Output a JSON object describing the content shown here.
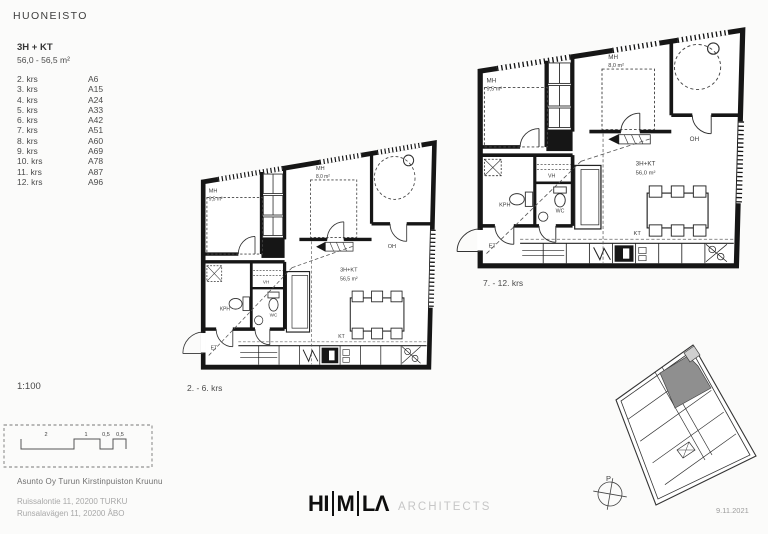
{
  "sheet": {
    "title": "HUONEISTO"
  },
  "apartment": {
    "type": "3H + KT",
    "area_range": "56,0 - 56,5 m²"
  },
  "floor_units": [
    {
      "floor": "2. krs",
      "unit": "A6"
    },
    {
      "floor": "3. krs",
      "unit": "A15"
    },
    {
      "floor": "4. krs",
      "unit": "A24"
    },
    {
      "floor": "5. krs",
      "unit": "A33"
    },
    {
      "floor": "6. krs",
      "unit": "A42"
    },
    {
      "floor": "7. krs",
      "unit": "A51"
    },
    {
      "floor": "8. krs",
      "unit": "A60"
    },
    {
      "floor": "9. krs",
      "unit": "A69"
    },
    {
      "floor": "10. krs",
      "unit": "A78"
    },
    {
      "floor": "11. krs",
      "unit": "A87"
    },
    {
      "floor": "12. krs",
      "unit": "A96"
    }
  ],
  "scale": {
    "ratio": "1:100",
    "bar_labels": [
      "2",
      "1",
      "0,5",
      "0,5"
    ]
  },
  "project": {
    "name": "Asunto Oy Turun Kirstinpuiston Kruunu",
    "address_fi": "Ruissalontie 11, 20200 TURKU",
    "address_sv": "Runsalavägen 11, 20200 ÅBO"
  },
  "plans": [
    {
      "caption": "2. - 6. krs",
      "unit_type": "3H+KT",
      "unit_area": "56,5 m²",
      "rooms": {
        "mh1": "MH",
        "mh1_area": "9,5 m²",
        "mh2": "MH",
        "mh2_area": "8,0 m²",
        "oh": "OH",
        "kph": "KPH",
        "wc": "WC",
        "vh": "VH",
        "et": "ET",
        "kt": "KT"
      }
    },
    {
      "caption": "7. - 12. krs",
      "unit_type": "3H+KT",
      "unit_area": "56,0 m²",
      "rooms": {
        "mh1": "MH",
        "mh1_area": "9,5 m²",
        "mh2": "MH",
        "mh2_area": "8,0 m²",
        "oh": "OH",
        "kph": "KPH",
        "wc": "WC",
        "vh": "VH",
        "et": "ET",
        "kt": "KT"
      }
    }
  ],
  "logo": {
    "letters": [
      "HI",
      "M",
      "LΛ"
    ],
    "suffix": "ARCHITECTS"
  },
  "siteplan": {
    "north": "P",
    "date": "9.11.2021"
  },
  "colors": {
    "wall": "#161616",
    "text_dark": "#3c3c3c",
    "text_light": "#a8a8a8",
    "logo_gray": "#c6c6c6",
    "highlight_unit": "#8f8f8f",
    "highlight_unit_light": "#cfcfcf"
  }
}
